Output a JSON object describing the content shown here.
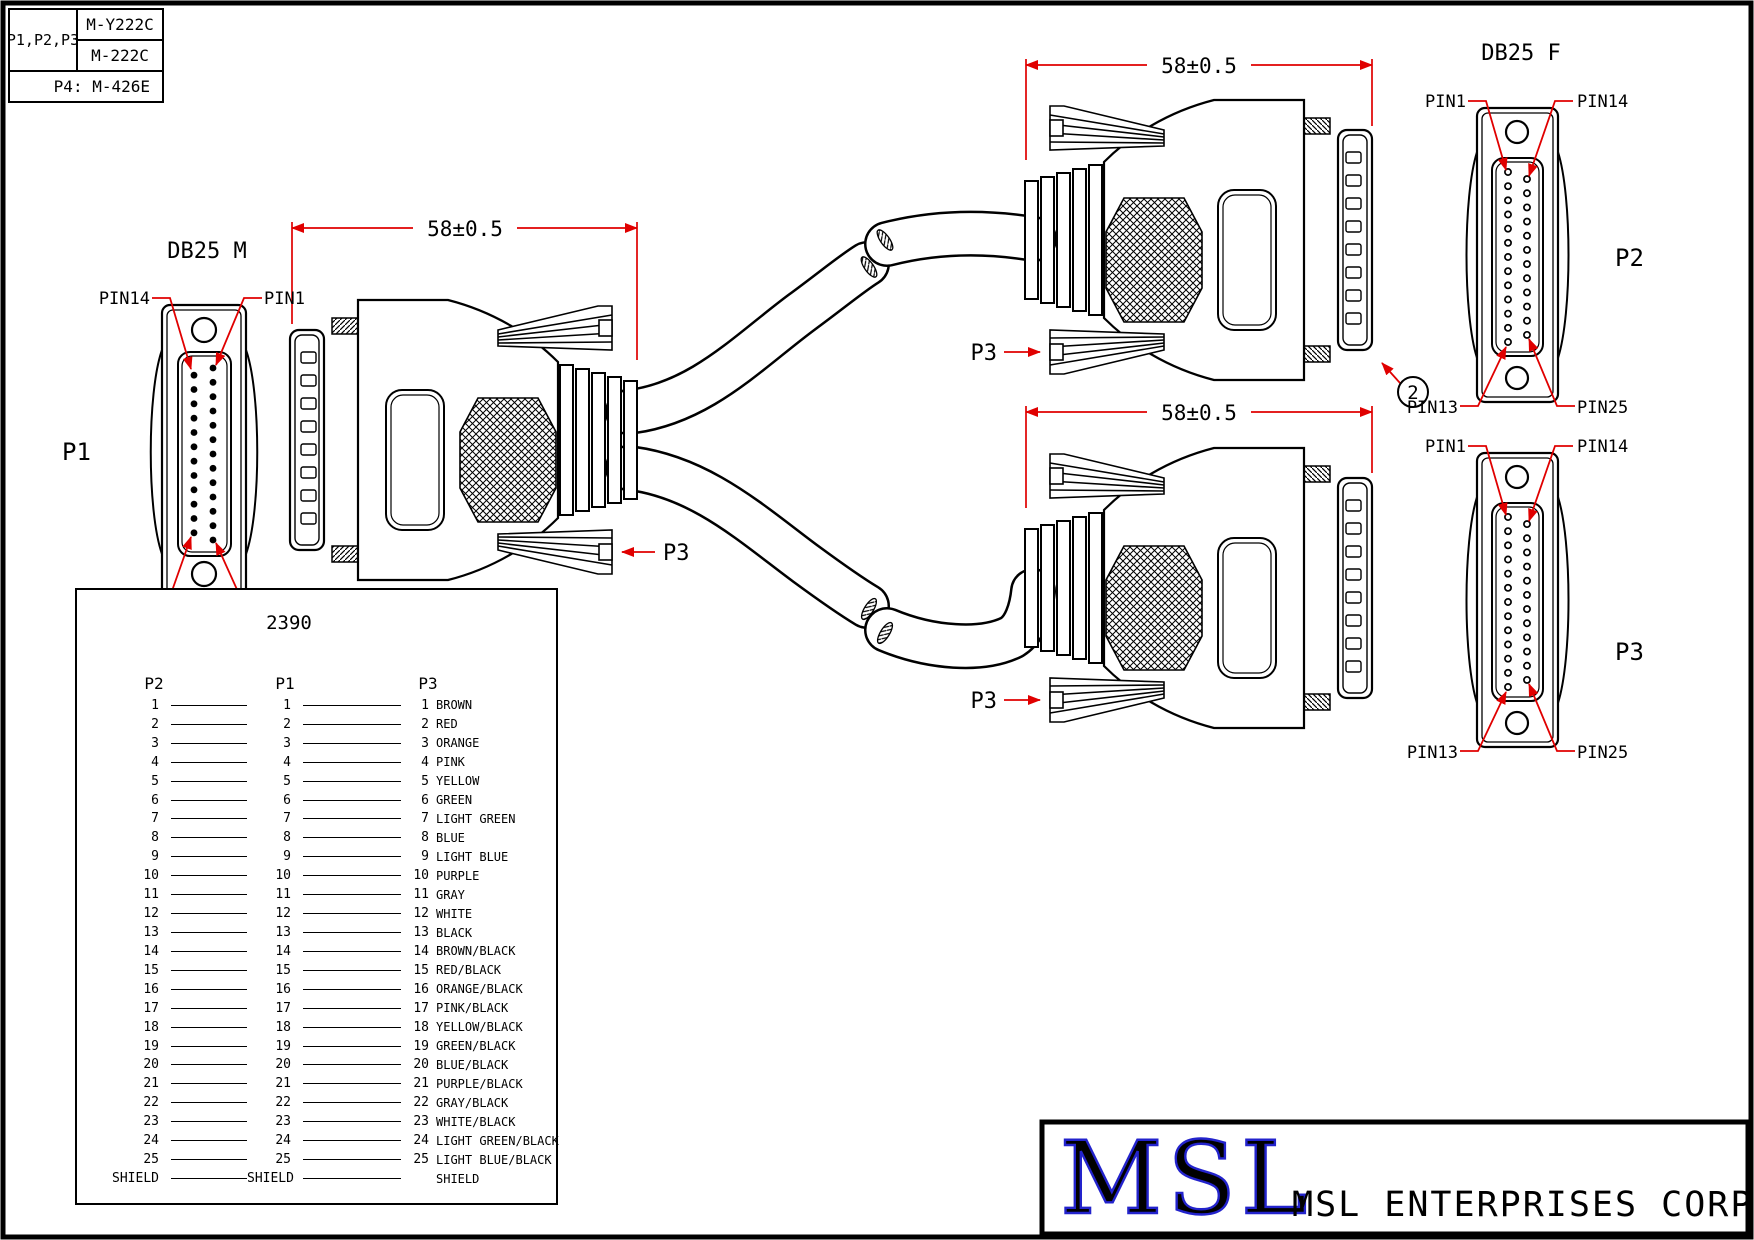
{
  "part_table": {
    "pins_label": "P1,P2,P3",
    "part_a": "M-Y222C",
    "part_b": "M-222C",
    "p4_label": "P4: M-426E"
  },
  "connectors": {
    "p1": {
      "title": "DB25 M",
      "name": "P1",
      "pin_labels": {
        "top_left": "PIN14",
        "top_right": "PIN1",
        "bottom_left": "PIN25",
        "bottom_right": "PIN13"
      }
    },
    "p2": {
      "title": "DB25 F",
      "name": "P2",
      "pin_labels": {
        "top_left": "PIN1",
        "top_right": "PIN14",
        "bottom_left": "PIN13",
        "bottom_right": "PIN25"
      }
    },
    "p3": {
      "name": "P3",
      "pin_labels": {
        "top_left": "PIN1",
        "top_right": "PIN14",
        "bottom_left": "PIN13",
        "bottom_right": "PIN25"
      }
    }
  },
  "dimensions": {
    "length": "58±0.5"
  },
  "callouts": {
    "balloon": "2",
    "cable_label": "P3"
  },
  "wiring_table": {
    "title": "2390",
    "headers": [
      "P2",
      "P1",
      "P3"
    ],
    "rows": [
      [
        "1",
        "1",
        "1",
        "BROWN"
      ],
      [
        "2",
        "2",
        "2",
        "RED"
      ],
      [
        "3",
        "3",
        "3",
        "ORANGE"
      ],
      [
        "4",
        "4",
        "4",
        "PINK"
      ],
      [
        "5",
        "5",
        "5",
        "YELLOW"
      ],
      [
        "6",
        "6",
        "6",
        "GREEN"
      ],
      [
        "7",
        "7",
        "7",
        "LIGHT GREEN"
      ],
      [
        "8",
        "8",
        "8",
        "BLUE"
      ],
      [
        "9",
        "9",
        "9",
        "LIGHT BLUE"
      ],
      [
        "10",
        "10",
        "10",
        "PURPLE"
      ],
      [
        "11",
        "11",
        "11",
        "GRAY"
      ],
      [
        "12",
        "12",
        "12",
        "WHITE"
      ],
      [
        "13",
        "13",
        "13",
        "BLACK"
      ],
      [
        "14",
        "14",
        "14",
        "BROWN/BLACK"
      ],
      [
        "15",
        "15",
        "15",
        "RED/BLACK"
      ],
      [
        "16",
        "16",
        "16",
        "ORANGE/BLACK"
      ],
      [
        "17",
        "17",
        "17",
        "PINK/BLACK"
      ],
      [
        "18",
        "18",
        "18",
        "YELLOW/BLACK"
      ],
      [
        "19",
        "19",
        "19",
        "GREEN/BLACK"
      ],
      [
        "20",
        "20",
        "20",
        "BLUE/BLACK"
      ],
      [
        "21",
        "21",
        "21",
        "PURPLE/BLACK"
      ],
      [
        "22",
        "22",
        "22",
        "GRAY/BLACK"
      ],
      [
        "23",
        "23",
        "23",
        "WHITE/BLACK"
      ],
      [
        "24",
        "24",
        "24",
        "LIGHT GREEN/BLACK"
      ],
      [
        "25",
        "25",
        "25",
        "LIGHT BLUE/BLACK"
      ],
      [
        "SHIELD",
        "SHIELD",
        "",
        "SHIELD"
      ]
    ]
  },
  "title_block": {
    "logo": "MSL",
    "company": "MSL ENTERPRISES CORP."
  },
  "colors": {
    "annotation_red": "#e00000",
    "logo_blue": "#2323cc"
  }
}
